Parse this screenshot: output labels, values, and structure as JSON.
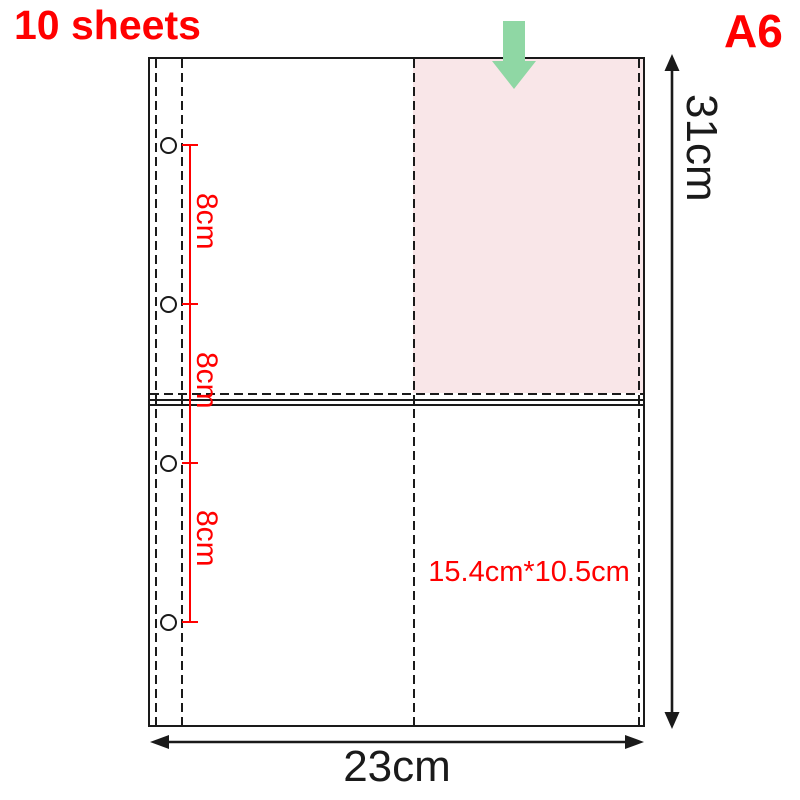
{
  "page": {
    "title_left": "10 sheets",
    "title_right": "A6"
  },
  "dimensions": {
    "sheet_height": "31cm",
    "sheet_width": "23cm",
    "pocket_size": "15.4cm*10.5cm",
    "hole_spacings": [
      "8cm",
      "8cm",
      "8cm"
    ]
  },
  "icons": {
    "insert_arrow": "down-arrow-icon"
  },
  "colors": {
    "accent_red": "#ff0000",
    "pocket_pink": "#f9e6e8",
    "arrow_green": "#8fd7a4",
    "line": "#1a1a1a"
  }
}
